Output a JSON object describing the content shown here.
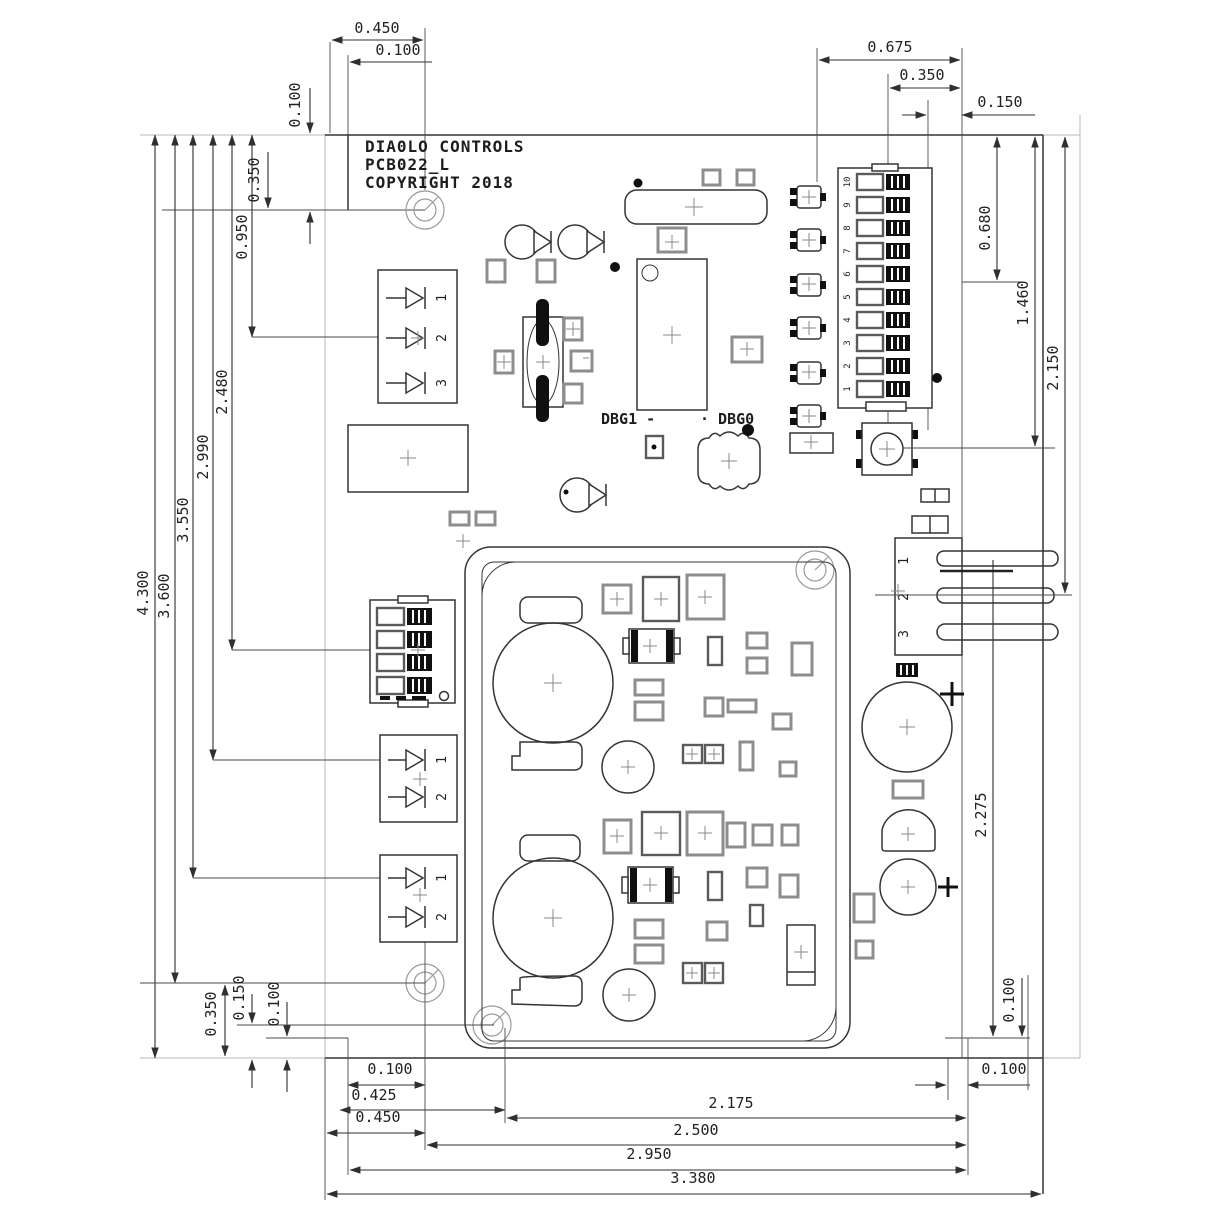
{
  "title": {
    "line1": "DIA0LO CONTROLS",
    "line2": "PCB022_L",
    "line3": "COPYRIGHT 2018"
  },
  "labels": {
    "dbg1": "DBG1 -",
    "dbg0": "· DBG0"
  },
  "dimensions": {
    "top": {
      "d450": "0.450",
      "d100h": "0.100",
      "d100v": "0.100",
      "d350v": "0.350"
    },
    "left": {
      "d4300": "4.300",
      "d3600": "3.600",
      "d3550": "3.550",
      "d2990": "2.990",
      "d2480": "2.480",
      "d950": "0.950"
    },
    "top_right": {
      "d675": "0.675",
      "d350": "0.350",
      "d150": "0.150"
    },
    "right": {
      "d680": "0.680",
      "d1460": "1.460",
      "d2150": "2.150",
      "d2275": "2.275",
      "d100v": "0.100",
      "d100h": "0.100"
    },
    "bottom_left": {
      "d350": "0.350",
      "d150": "0.150",
      "d100": "0.100"
    },
    "bottom": {
      "d100": "0.100",
      "d425": "0.425",
      "d450": "0.450",
      "d2175": "2.175",
      "d2500": "2.500",
      "d2950": "2.950",
      "d3380": "3.380"
    }
  },
  "terminal_block_top": {
    "pins": [
      "1",
      "2",
      "3"
    ]
  },
  "terminal_block_mid": {
    "pins": [
      "1",
      "2"
    ]
  },
  "terminal_block_bottom": {
    "pins": [
      "1",
      "2"
    ]
  },
  "connector_right": {
    "pins": [
      "1",
      "2",
      "3"
    ]
  },
  "dip_switch_10": {
    "positions": [
      "10",
      "9",
      "8",
      "7",
      "6",
      "5",
      "4",
      "3",
      "2",
      "1"
    ]
  },
  "colors": {
    "line": "#343434",
    "light_line": "#b9b9b9",
    "pad_gray": "#8d8d8d",
    "black_fill": "#101010",
    "background": "#ffffff"
  }
}
